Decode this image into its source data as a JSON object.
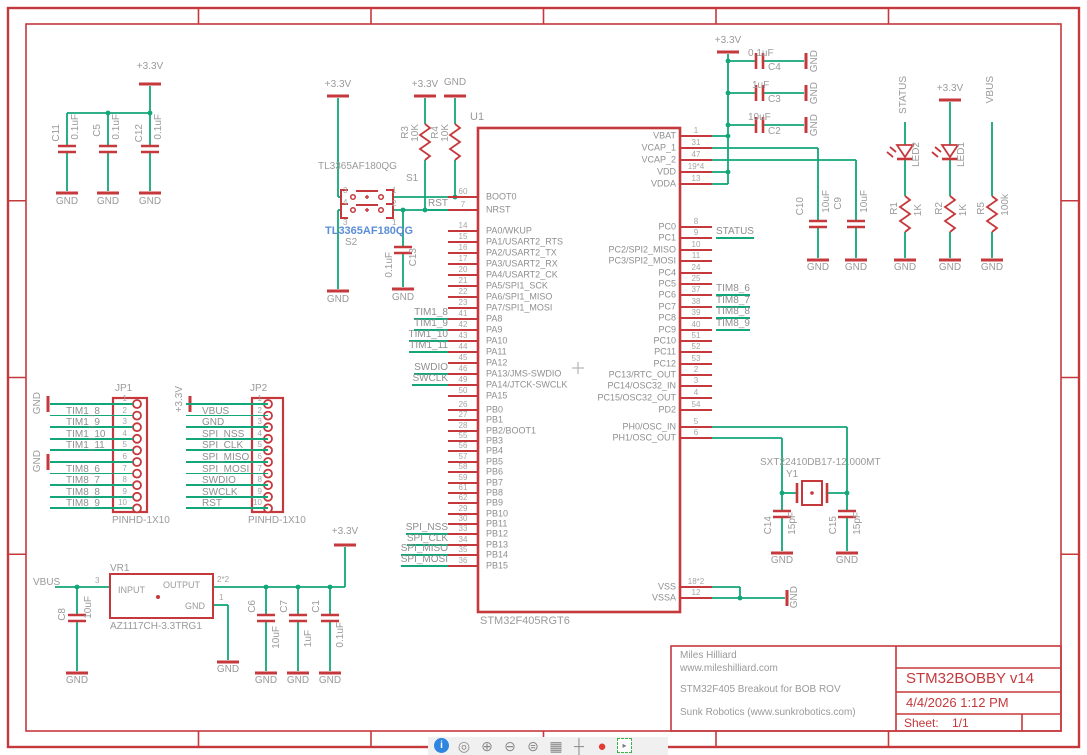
{
  "frame": {
    "columns": [
      "1",
      "2",
      "3",
      "4",
      "5",
      "6"
    ],
    "rows": [
      "A",
      "B",
      "C",
      "D"
    ]
  },
  "power": {
    "v33": "+3.3V",
    "gnd": "GND",
    "vbus": "VBUS",
    "status": "STATUS"
  },
  "decoupling_caps": [
    {
      "ref": "C11",
      "value": "0.1uF"
    },
    {
      "ref": "C5",
      "value": "0.1uF"
    },
    {
      "ref": "C12",
      "value": "0.1uF"
    }
  ],
  "bulk_caps": [
    {
      "ref": "C4",
      "value": "0.1uF"
    },
    {
      "ref": "C3",
      "value": "1uF"
    },
    {
      "ref": "C2",
      "value": "10uF"
    }
  ],
  "vcap_caps": [
    {
      "ref": "C10",
      "value": "10uF"
    },
    {
      "ref": "C9",
      "value": "10uF"
    }
  ],
  "xtal_caps": [
    {
      "ref": "C14",
      "value": "15pF"
    },
    {
      "ref": "C15",
      "value": "15pF"
    }
  ],
  "switch_block": {
    "part1": "TL3365AF180QG",
    "s1": "S1",
    "part2": "TL3365AF180QG",
    "s2": "S2",
    "r_rst": {
      "ref": "R3",
      "value": "10K"
    },
    "r_boot": {
      "ref": "R4",
      "value": "10K"
    },
    "cap": {
      "ref": "C13",
      "value": "0.1uF"
    },
    "pin_labels": {
      "p1": "1",
      "p2": "2",
      "p3": "3",
      "p4": "4"
    }
  },
  "u1": {
    "ref": "U1",
    "part": "STM32F405RGT6",
    "boot_pins": [
      {
        "num": "60",
        "name": "BOOT0",
        "net": ""
      },
      {
        "num": "7",
        "name": "NRST",
        "net": "RST"
      }
    ],
    "pa_pins": [
      {
        "num": "14",
        "name": "PA0/WKUP",
        "net": ""
      },
      {
        "num": "15",
        "name": "PA1/USART2_RTS",
        "net": ""
      },
      {
        "num": "16",
        "name": "PA2/USART2_TX",
        "net": ""
      },
      {
        "num": "17",
        "name": "PA3/USART2_RX",
        "net": ""
      },
      {
        "num": "20",
        "name": "PA4/USART2_CK",
        "net": ""
      },
      {
        "num": "21",
        "name": "PA5/SPI1_SCK",
        "net": ""
      },
      {
        "num": "22",
        "name": "PA6/SPI1_MISO",
        "net": ""
      },
      {
        "num": "23",
        "name": "PA7/SPI1_MOSI",
        "net": ""
      },
      {
        "num": "41",
        "name": "PA8",
        "net": "TIM1_8"
      },
      {
        "num": "42",
        "name": "PA9",
        "net": "TIM1_9"
      },
      {
        "num": "43",
        "name": "PA10",
        "net": "TIM1_10"
      },
      {
        "num": "44",
        "name": "PA11",
        "net": "TIM1_11"
      },
      {
        "num": "45",
        "name": "PA12",
        "net": ""
      },
      {
        "num": "46",
        "name": "PA13/JMS-SWDIO",
        "net": "SWDIO"
      },
      {
        "num": "49",
        "name": "PA14/JTCK-SWCLK",
        "net": "SWCLK"
      },
      {
        "num": "50",
        "name": "PA15",
        "net": ""
      }
    ],
    "pb_pins": [
      {
        "num": "26",
        "name": "PB0",
        "net": ""
      },
      {
        "num": "27",
        "name": "PB1",
        "net": ""
      },
      {
        "num": "28",
        "name": "PB2/BOOT1",
        "net": ""
      },
      {
        "num": "55",
        "name": "PB3",
        "net": ""
      },
      {
        "num": "56",
        "name": "PB4",
        "net": ""
      },
      {
        "num": "57",
        "name": "PB5",
        "net": ""
      },
      {
        "num": "58",
        "name": "PB6",
        "net": ""
      },
      {
        "num": "59",
        "name": "PB7",
        "net": ""
      },
      {
        "num": "61",
        "name": "PB8",
        "net": ""
      },
      {
        "num": "62",
        "name": "PB9",
        "net": ""
      },
      {
        "num": "29",
        "name": "PB10",
        "net": ""
      },
      {
        "num": "30",
        "name": "PB11",
        "net": ""
      },
      {
        "num": "33",
        "name": "PB12",
        "net": "SPI_NSS"
      },
      {
        "num": "34",
        "name": "PB13",
        "net": "SPI_CLK"
      },
      {
        "num": "35",
        "name": "PB14",
        "net": "SPI_MISO"
      },
      {
        "num": "36",
        "name": "PB15",
        "net": "SPI_MOSI"
      }
    ],
    "pwr_pins": [
      {
        "num": "1",
        "name": "VBAT",
        "net": ""
      },
      {
        "num": "31",
        "name": "VCAP_1",
        "net": ""
      },
      {
        "num": "47",
        "name": "VCAP_2",
        "net": ""
      },
      {
        "num": "19*4",
        "name": "VDD",
        "net": ""
      },
      {
        "num": "13",
        "name": "VDDA",
        "net": ""
      }
    ],
    "pc_pins": [
      {
        "num": "8",
        "name": "PC0",
        "net": ""
      },
      {
        "num": "9",
        "name": "PC1",
        "net": "STATUS"
      },
      {
        "num": "10",
        "name": "PC2/SPI2_MISO",
        "net": ""
      },
      {
        "num": "11",
        "name": "PC3/SPI2_MOSI",
        "net": ""
      },
      {
        "num": "24",
        "name": "PC4",
        "net": ""
      },
      {
        "num": "25",
        "name": "PC5",
        "net": ""
      },
      {
        "num": "37",
        "name": "PC6",
        "net": "TIM8_6"
      },
      {
        "num": "38",
        "name": "PC7",
        "net": "TIM8_7"
      },
      {
        "num": "39",
        "name": "PC8",
        "net": "TIM8_8"
      },
      {
        "num": "40",
        "name": "PC9",
        "net": "TIM8_9"
      },
      {
        "num": "51",
        "name": "PC10",
        "net": ""
      },
      {
        "num": "52",
        "name": "PC11",
        "net": ""
      },
      {
        "num": "53",
        "name": "PC12",
        "net": ""
      },
      {
        "num": "2",
        "name": "PC13/RTC_OUT",
        "net": ""
      },
      {
        "num": "3",
        "name": "PC14/OSC32_IN",
        "net": ""
      },
      {
        "num": "4",
        "name": "PC15/OSC32_OUT",
        "net": ""
      }
    ],
    "pd_pins": [
      {
        "num": "54",
        "name": "PD2",
        "net": ""
      }
    ],
    "ph_pins": [
      {
        "num": "5",
        "name": "PH0/OSC_IN",
        "net": ""
      },
      {
        "num": "6",
        "name": "PH1/OSC_OUT",
        "net": ""
      }
    ],
    "gnd_pins": [
      {
        "num": "18*2",
        "name": "VSS",
        "net": ""
      },
      {
        "num": "12",
        "name": "VSSA",
        "net": ""
      }
    ]
  },
  "jp1": {
    "ref": "JP1",
    "part": "PINHD-1X10",
    "pins": [
      {
        "num": "1",
        "net": ""
      },
      {
        "num": "2",
        "net": "TIM1_8"
      },
      {
        "num": "3",
        "net": "TIM1_9"
      },
      {
        "num": "4",
        "net": "TIM1_10"
      },
      {
        "num": "5",
        "net": "TIM1_11"
      },
      {
        "num": "6",
        "net": ""
      },
      {
        "num": "7",
        "net": "TIM8_6"
      },
      {
        "num": "8",
        "net": "TIM8_7"
      },
      {
        "num": "9",
        "net": "TIM8_8"
      },
      {
        "num": "10",
        "net": "TIM8_9"
      }
    ]
  },
  "jp2": {
    "ref": "JP2",
    "part": "PINHD-1X10",
    "pins": [
      {
        "num": "1",
        "net": ""
      },
      {
        "num": "2",
        "net": "VBUS"
      },
      {
        "num": "3",
        "net": "GND"
      },
      {
        "num": "4",
        "net": "SPI_NSS"
      },
      {
        "num": "5",
        "net": "SPI_CLK"
      },
      {
        "num": "6",
        "net": "SPI_MISO"
      },
      {
        "num": "7",
        "net": "SPI_MOSI"
      },
      {
        "num": "8",
        "net": "SWDIO"
      },
      {
        "num": "9",
        "net": "SWCLK"
      },
      {
        "num": "10",
        "net": "RST"
      }
    ]
  },
  "regulator": {
    "ref": "VR1",
    "part": "AZ1117CH-3.3TRG1",
    "lbl_in": "INPUT",
    "lbl_out": "OUTPUT",
    "lbl_gnd": "GND",
    "pin_in": "3",
    "pin_out": "2*2",
    "pin_gnd": "1",
    "cap_in": {
      "ref": "C8",
      "value": "10uF"
    },
    "caps_out": [
      {
        "ref": "C6",
        "value": "10uF"
      },
      {
        "ref": "C7",
        "value": "1uF"
      },
      {
        "ref": "C1",
        "value": "0.1uF"
      }
    ]
  },
  "leds": {
    "led2": {
      "ref": "LED2",
      "res_ref": "R1",
      "res_val": "1K"
    },
    "led1": {
      "ref": "LED1",
      "res_ref": "R2",
      "res_val": "1K"
    },
    "vbus_res": {
      "ref": "R5",
      "value": "100k"
    }
  },
  "crystal": {
    "ref": "Y1",
    "part": "SXT22410DB17-12.000MT"
  },
  "title_block": {
    "author": "Miles Hilliard",
    "website": "www.mileshilliard.com",
    "description": "STM32F405 Breakout for BOB ROV",
    "company": "Sunk Robotics (www.sunkrobotics.com)",
    "title": "STM32BOBBY v14",
    "date": "4/4/2026 1:12 PM",
    "sheet_label": "Sheet:",
    "sheet": "1/1"
  },
  "toolbar": {
    "icons": [
      "info",
      "preview",
      "zoom-in",
      "zoom-out",
      "zoom-fit",
      "grid",
      "origin",
      "stop",
      "select-region"
    ]
  }
}
